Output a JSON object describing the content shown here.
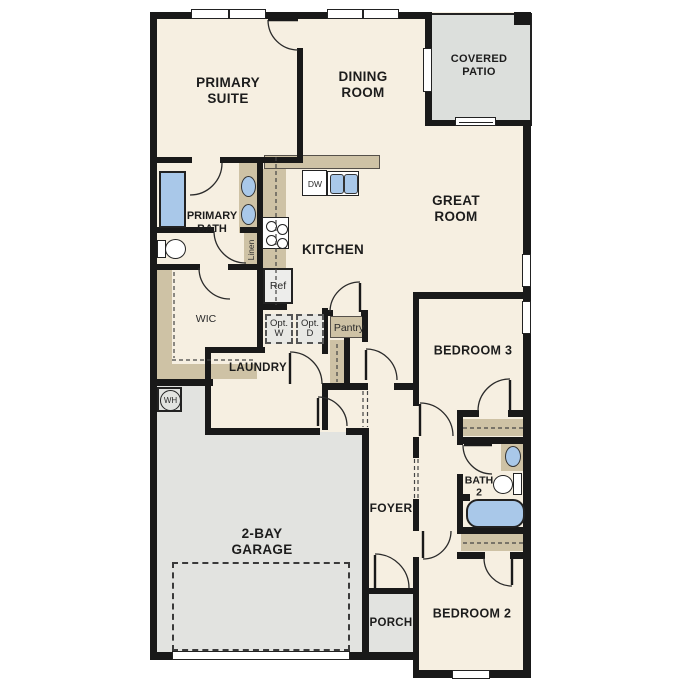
{
  "title": "Single-story floor plan",
  "labels": {
    "primary_suite_l1": "PRIMARY",
    "primary_suite_l2": "SUITE",
    "dining_l1": "DINING",
    "dining_l2": "ROOM",
    "patio_l1": "COVERED",
    "patio_l2": "PATIO",
    "great_l1": "GREAT",
    "great_l2": "ROOM",
    "kitchen": "KITCHEN",
    "primary_bath_l1": "PRIMARY",
    "primary_bath_l2": "BATH",
    "linen": "Linen",
    "wic": "WIC",
    "ref": "Ref",
    "dw": "DW",
    "opt_w_l1": "Opt.",
    "opt_w_l2": "W",
    "opt_d_l1": "Opt.",
    "opt_d_l2": "D",
    "pantry": "Pantry",
    "laundry": "LAUNDRY",
    "wh": "WH",
    "garage_l1": "2-BAY",
    "garage_l2": "GARAGE",
    "foyer": "FOYER",
    "porch": "PORCH",
    "bedroom3": "BEDROOM 3",
    "bedroom2": "BEDROOM 2",
    "bath2_l1": "BATH",
    "bath2_l2": "2"
  },
  "colors": {
    "floor": "#f6efe1",
    "outdoor_gray": "#e2e3e0",
    "patio_gray": "#dcdfdc",
    "counter_tan": "#cec2a5",
    "fixture_blue": "#a9c8e9",
    "wall_black": "#191919"
  },
  "fixtures": [
    "shower",
    "double-vanity-sinks",
    "toilet",
    "linen-closet",
    "range",
    "refrigerator",
    "dishwasher",
    "double-kitchen-sink",
    "optional-washer",
    "optional-dryer",
    "pantry",
    "water-heater",
    "bathtub",
    "bath2-sink",
    "bath2-toilet",
    "bedroom-closets",
    "garage-door",
    "sliding-patio-door",
    "windows"
  ]
}
